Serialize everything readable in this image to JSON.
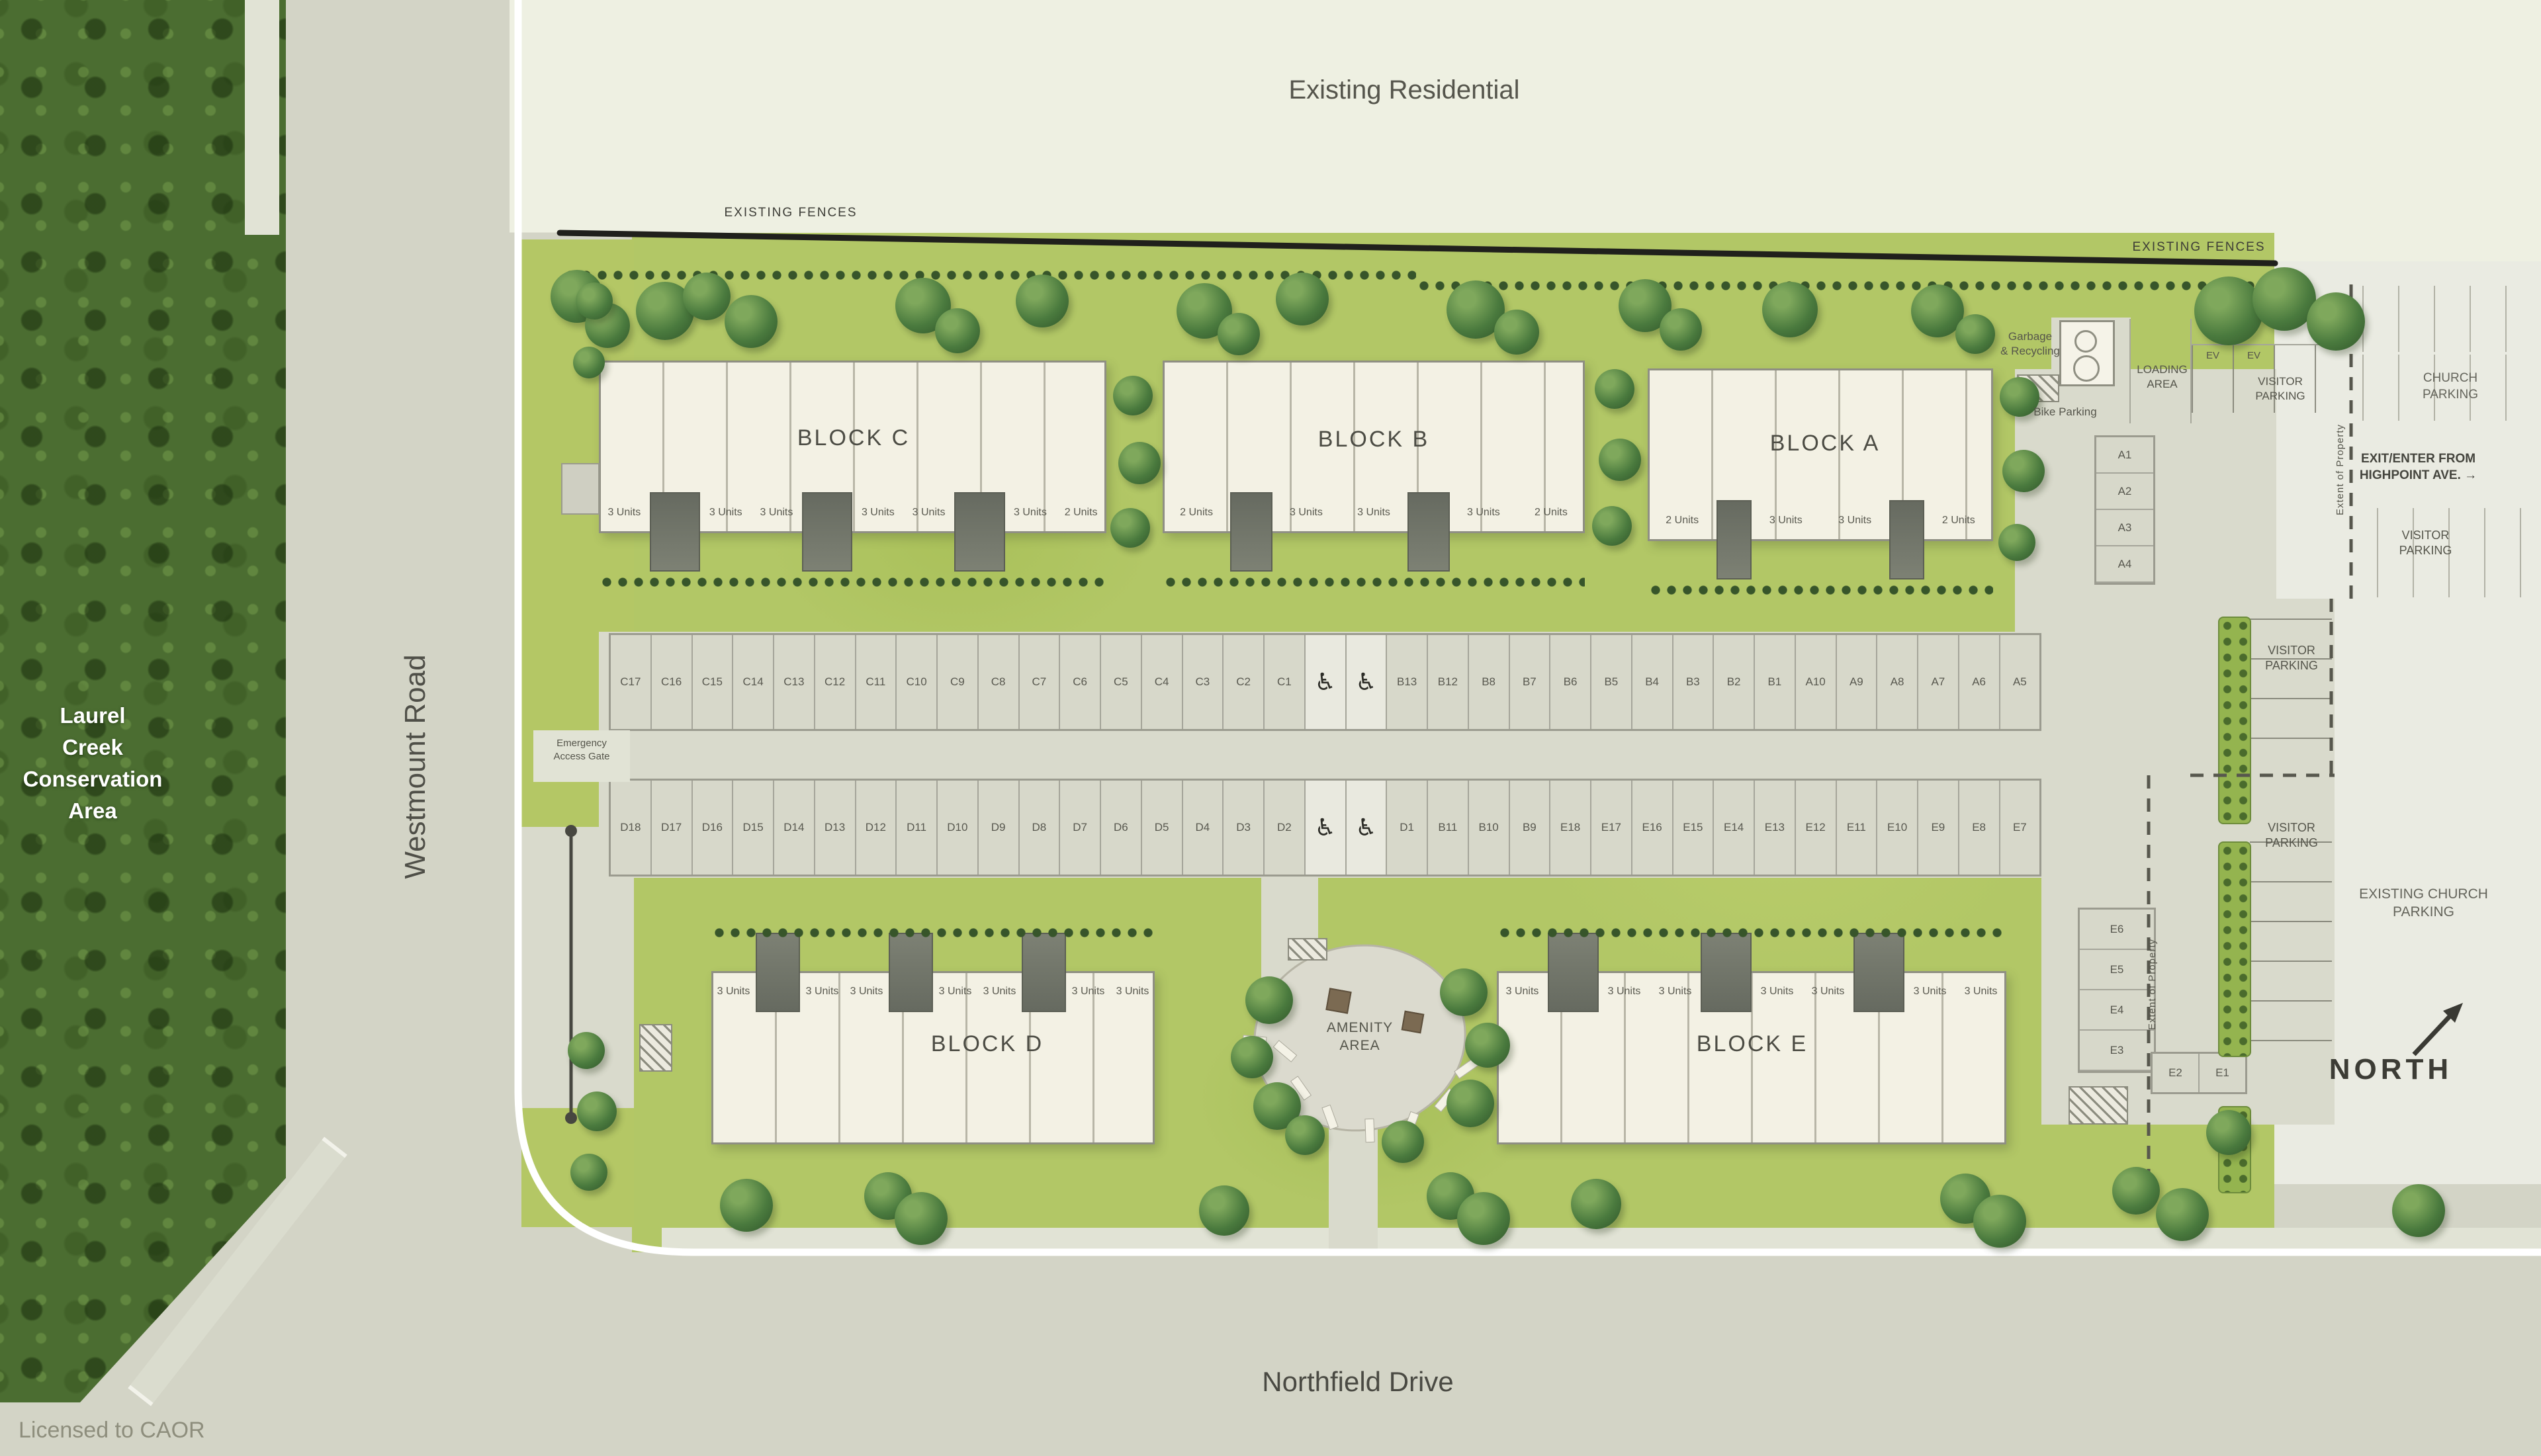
{
  "map": {
    "existing_residential": "Existing Residential",
    "existing_fences_left": "EXISTING FENCES",
    "existing_fences_right": "EXISTING FENCES",
    "conservation_area": [
      "Laurel",
      "Creek",
      "Conservation",
      "Area"
    ],
    "westmount_road": "Westmount Road",
    "northfield_drive": "Northfield Drive",
    "licensed_to": "Licensed to CAOR",
    "north": "NORTH",
    "amenity_area": [
      "AMENITY",
      "AREA"
    ],
    "emergency_access_gate": [
      "Emergency",
      "Access Gate"
    ],
    "garbage_recycling": [
      "Garbage",
      "& Recycling"
    ],
    "bike_parking": "Bike Parking",
    "loading_area": [
      "LOADING",
      "AREA"
    ],
    "visitor_parking_top": [
      "VISITOR",
      "PARKING"
    ],
    "visitor_parking_highpoint": [
      "VISITOR",
      "PARKING"
    ],
    "visitor_parking_mid_upper": [
      "VISITOR",
      "PARKING"
    ],
    "visitor_parking_mid_lower": [
      "VISITOR",
      "PARKING"
    ],
    "church_parking": [
      "CHURCH",
      "PARKING"
    ],
    "exit_enter_highpoint": [
      "EXIT/ENTER FROM",
      "HIGHPOINT AVE. →"
    ],
    "existing_church_parking": [
      "EXISTING CHURCH",
      "PARKING"
    ],
    "extent_of_property_east": "Extent of Property",
    "extent_of_property_south": "Extent of Property",
    "ev_1": "EV",
    "ev_2": "EV"
  },
  "icons": {
    "accessible_parking": "♿"
  },
  "blocks": [
    {
      "id": "C",
      "label": "BLOCK C",
      "units": [
        "3 Units",
        "3 Units",
        "3 Units",
        "3 Units",
        "3 Units",
        "3 Units",
        "2 Units"
      ]
    },
    {
      "id": "B",
      "label": "BLOCK B",
      "units": [
        "2 Units",
        "3 Units",
        "3 Units",
        "3 Units",
        "2 Units"
      ]
    },
    {
      "id": "A",
      "label": "BLOCK A",
      "units": [
        "2 Units",
        "3 Units",
        "3 Units",
        "2 Units"
      ]
    },
    {
      "id": "D",
      "label": "BLOCK D",
      "units": [
        "3 Units",
        "3 Units",
        "3 Units",
        "3 Units",
        "3 Units",
        "3 Units",
        "3 Units"
      ]
    },
    {
      "id": "E",
      "label": "BLOCK E",
      "units": [
        "3 Units",
        "3 Units",
        "3 Units",
        "3 Units",
        "3 Units",
        "3 Units",
        "3 Units"
      ]
    }
  ],
  "parking": {
    "row_north": [
      "C17",
      "C16",
      "C15",
      "C14",
      "C13",
      "C12",
      "C11",
      "C10",
      "C9",
      "C8",
      "C7",
      "C6",
      "C5",
      "C4",
      "C3",
      "C2",
      "C1",
      "ACC",
      "ACC",
      "B13",
      "B12",
      "B8",
      "B7",
      "B6",
      "B5",
      "B4",
      "B3",
      "B2",
      "B1",
      "A10",
      "A9",
      "A8",
      "A7",
      "A6",
      "A5"
    ],
    "row_south": [
      "D18",
      "D17",
      "D16",
      "D15",
      "D14",
      "D13",
      "D12",
      "D11",
      "D10",
      "D9",
      "D8",
      "D7",
      "D6",
      "D5",
      "D4",
      "D3",
      "D2",
      "ACC",
      "ACC",
      "D1",
      "B11",
      "B10",
      "B9",
      "E18",
      "E17",
      "E16",
      "E15",
      "E14",
      "E13",
      "E12",
      "E11",
      "E10",
      "E9",
      "E8",
      "E7"
    ],
    "column_a": [
      "A1",
      "A2",
      "A3",
      "A4"
    ],
    "column_e": [
      "E6",
      "E5",
      "E4",
      "E3"
    ],
    "pair_e": [
      "E2",
      "E1"
    ]
  }
}
